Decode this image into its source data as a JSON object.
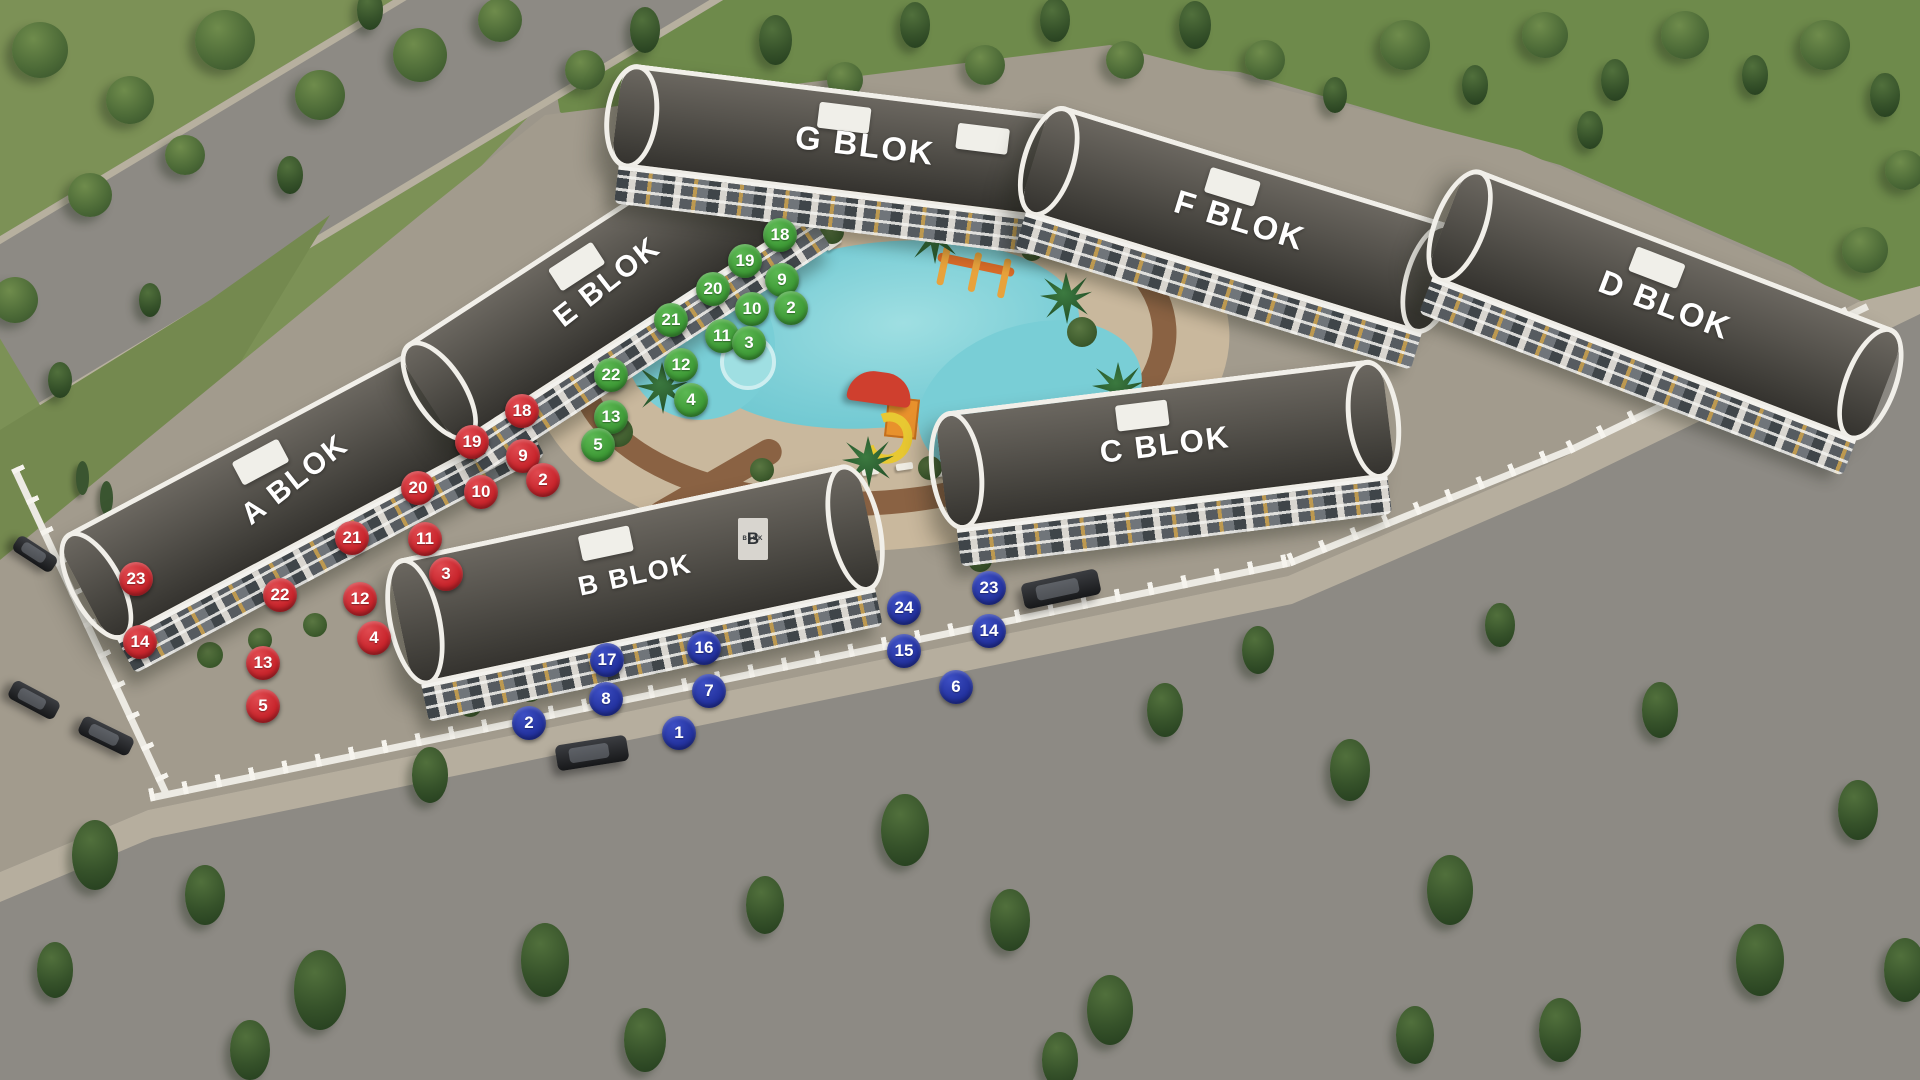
{
  "scene": {
    "blocks": [
      {
        "id": "A",
        "label": "A BLOK"
      },
      {
        "id": "B",
        "label": "B BLOK"
      },
      {
        "id": "C",
        "label": "C BLOK"
      },
      {
        "id": "D",
        "label": "D BLOK"
      },
      {
        "id": "E",
        "label": "E BLOK"
      },
      {
        "id": "F",
        "label": "F BLOK"
      },
      {
        "id": "G",
        "label": "G BLOK"
      }
    ],
    "entrance_sign": {
      "monogram": "B",
      "text": "BLOK"
    }
  },
  "badges": {
    "colors": {
      "red": "#c8252c",
      "green": "#3f9b37",
      "blue": "#2433a0"
    },
    "groups": [
      {
        "block": "A",
        "color": "red",
        "units": [
          {
            "n": "18",
            "x": 522,
            "y": 411
          },
          {
            "n": "19",
            "x": 472,
            "y": 442
          },
          {
            "n": "9",
            "x": 523,
            "y": 456
          },
          {
            "n": "2",
            "x": 543,
            "y": 480
          },
          {
            "n": "20",
            "x": 418,
            "y": 488
          },
          {
            "n": "10",
            "x": 481,
            "y": 492
          },
          {
            "n": "21",
            "x": 352,
            "y": 538
          },
          {
            "n": "11",
            "x": 425,
            "y": 539
          },
          {
            "n": "3",
            "x": 446,
            "y": 574
          },
          {
            "n": "23",
            "x": 136,
            "y": 579
          },
          {
            "n": "22",
            "x": 280,
            "y": 595
          },
          {
            "n": "12",
            "x": 360,
            "y": 599
          },
          {
            "n": "4",
            "x": 374,
            "y": 638
          },
          {
            "n": "14",
            "x": 140,
            "y": 642
          },
          {
            "n": "13",
            "x": 263,
            "y": 663
          },
          {
            "n": "5",
            "x": 263,
            "y": 706
          }
        ]
      },
      {
        "block": "E",
        "color": "green",
        "units": [
          {
            "n": "18",
            "x": 780,
            "y": 235
          },
          {
            "n": "19",
            "x": 745,
            "y": 261
          },
          {
            "n": "9",
            "x": 782,
            "y": 280
          },
          {
            "n": "20",
            "x": 713,
            "y": 289
          },
          {
            "n": "2",
            "x": 791,
            "y": 308
          },
          {
            "n": "10",
            "x": 752,
            "y": 309
          },
          {
            "n": "21",
            "x": 671,
            "y": 320
          },
          {
            "n": "11",
            "x": 722,
            "y": 336
          },
          {
            "n": "3",
            "x": 749,
            "y": 343
          },
          {
            "n": "12",
            "x": 681,
            "y": 365
          },
          {
            "n": "22",
            "x": 611,
            "y": 375
          },
          {
            "n": "4",
            "x": 691,
            "y": 400
          },
          {
            "n": "13",
            "x": 611,
            "y": 417
          },
          {
            "n": "5",
            "x": 598,
            "y": 445
          }
        ]
      },
      {
        "block": "B",
        "color": "blue",
        "units": [
          {
            "n": "23",
            "x": 989,
            "y": 588
          },
          {
            "n": "24",
            "x": 904,
            "y": 608
          },
          {
            "n": "14",
            "x": 989,
            "y": 631
          },
          {
            "n": "16",
            "x": 704,
            "y": 648
          },
          {
            "n": "15",
            "x": 904,
            "y": 651
          },
          {
            "n": "17",
            "x": 607,
            "y": 660
          },
          {
            "n": "6",
            "x": 956,
            "y": 687
          },
          {
            "n": "7",
            "x": 709,
            "y": 691
          },
          {
            "n": "8",
            "x": 606,
            "y": 699
          },
          {
            "n": "2",
            "x": 529,
            "y": 723
          },
          {
            "n": "1",
            "x": 679,
            "y": 733
          }
        ]
      }
    ]
  }
}
